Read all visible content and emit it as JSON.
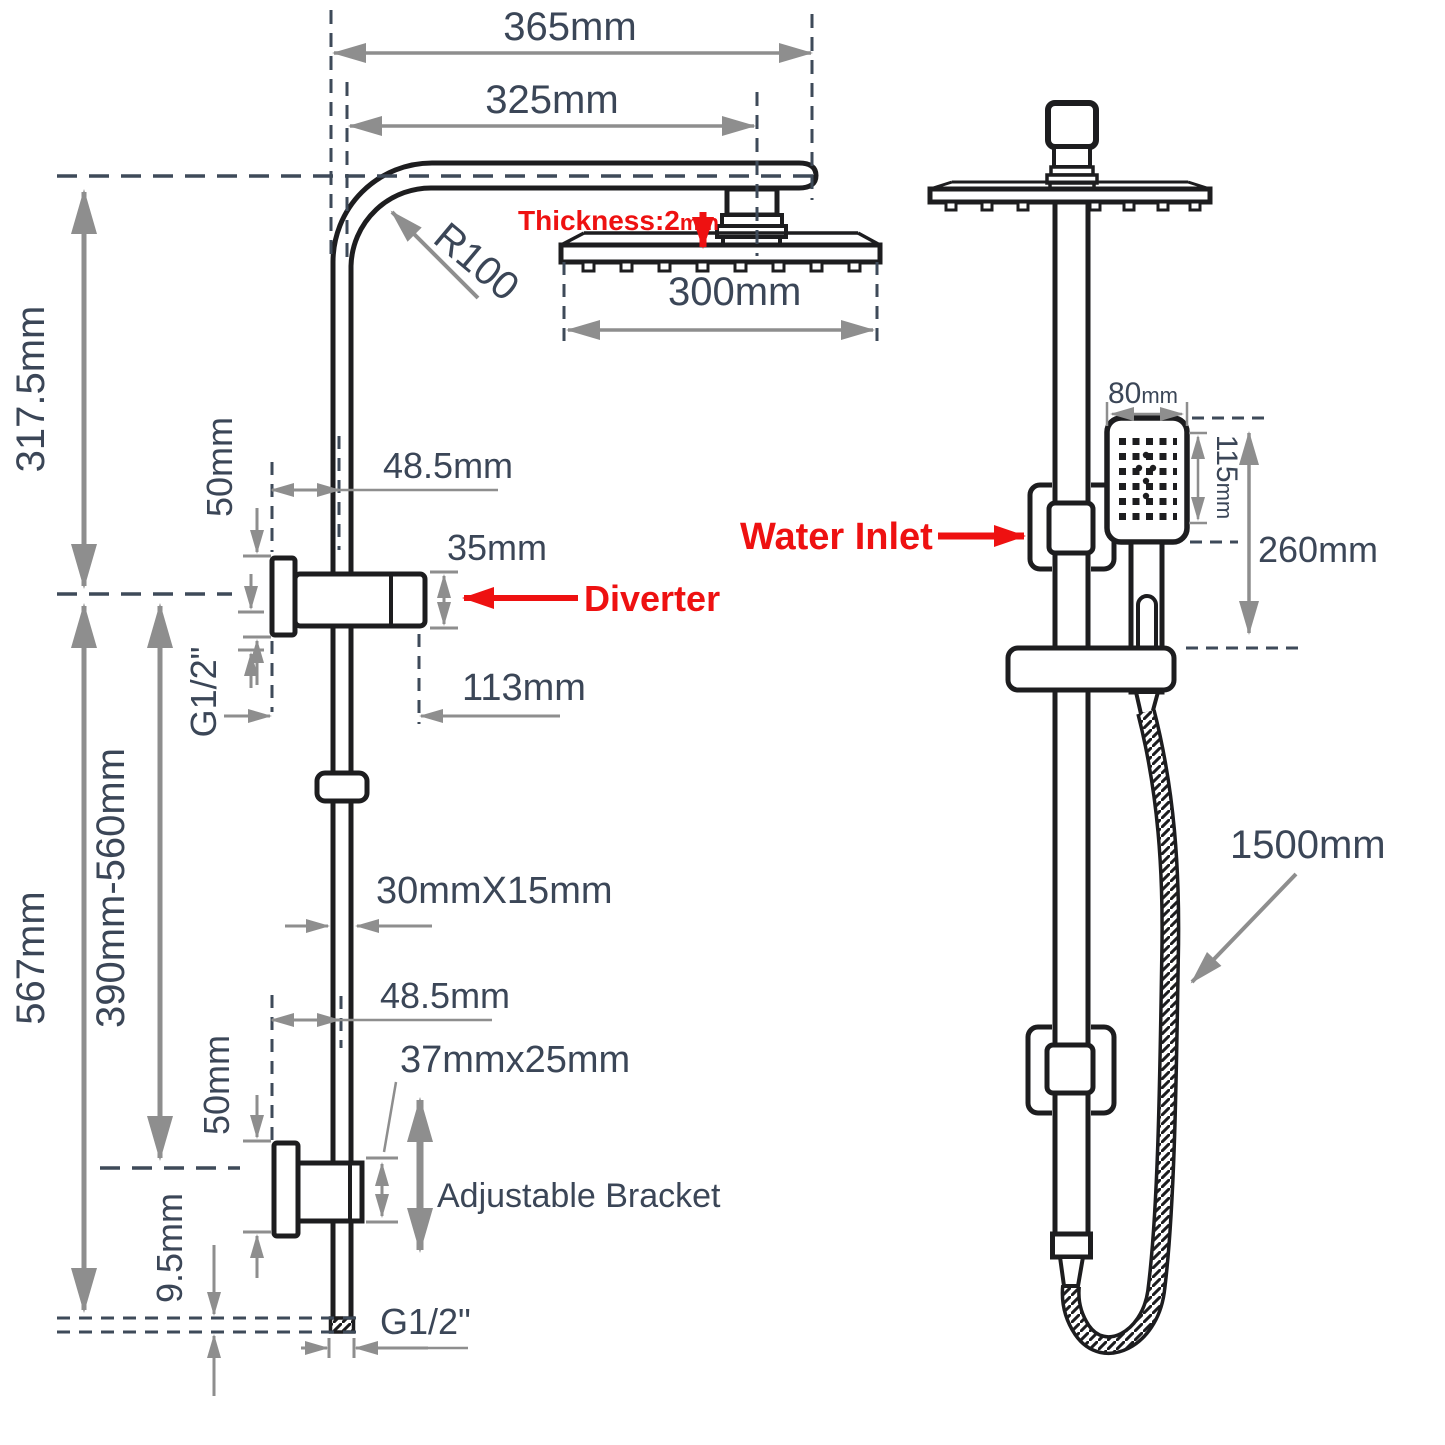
{
  "colors": {
    "drawing_line": "#1d1d1f",
    "dimension_line": "#8e8e8e",
    "dimension_text": "#3b4657",
    "datum_dash": "#3e4a59",
    "callout_red": "#ee1111"
  },
  "left_view": {
    "arm_overall_width": "365mm",
    "arm_inner_width": "325mm",
    "arm_radius": "R100",
    "head_thickness_value": "Thickness:2",
    "head_thickness_unit": "mm",
    "head_width": "300mm",
    "upper_height": "317.5mm",
    "diverter_plate_height": "50mm",
    "diverter_wall_offset": "48.5mm",
    "diverter_body_height": "35mm",
    "diverter_label": "Diverter",
    "inlet_thread": "G1/2\"",
    "diverter_depth": "113mm",
    "total_height": "567mm",
    "bracket_adjust_range": "390mm-560mm",
    "rail_section": "30mmX15mm",
    "bracket_wall_offset": "48.5mm",
    "bracket_section": "37mmx25mm",
    "bracket_plate_height": "50mm",
    "bracket_label": "Adjustable Bracket",
    "bottom_offset": "9.5mm",
    "outlet_thread": "G1/2\""
  },
  "right_view": {
    "handset_width_value": "80",
    "handset_width_unit": "mm",
    "handset_head_height_value": "115",
    "handset_head_height_unit": "mm",
    "handset_length": "260mm",
    "water_inlet_label": "Water Inlet",
    "hose_length": "1500mm"
  }
}
